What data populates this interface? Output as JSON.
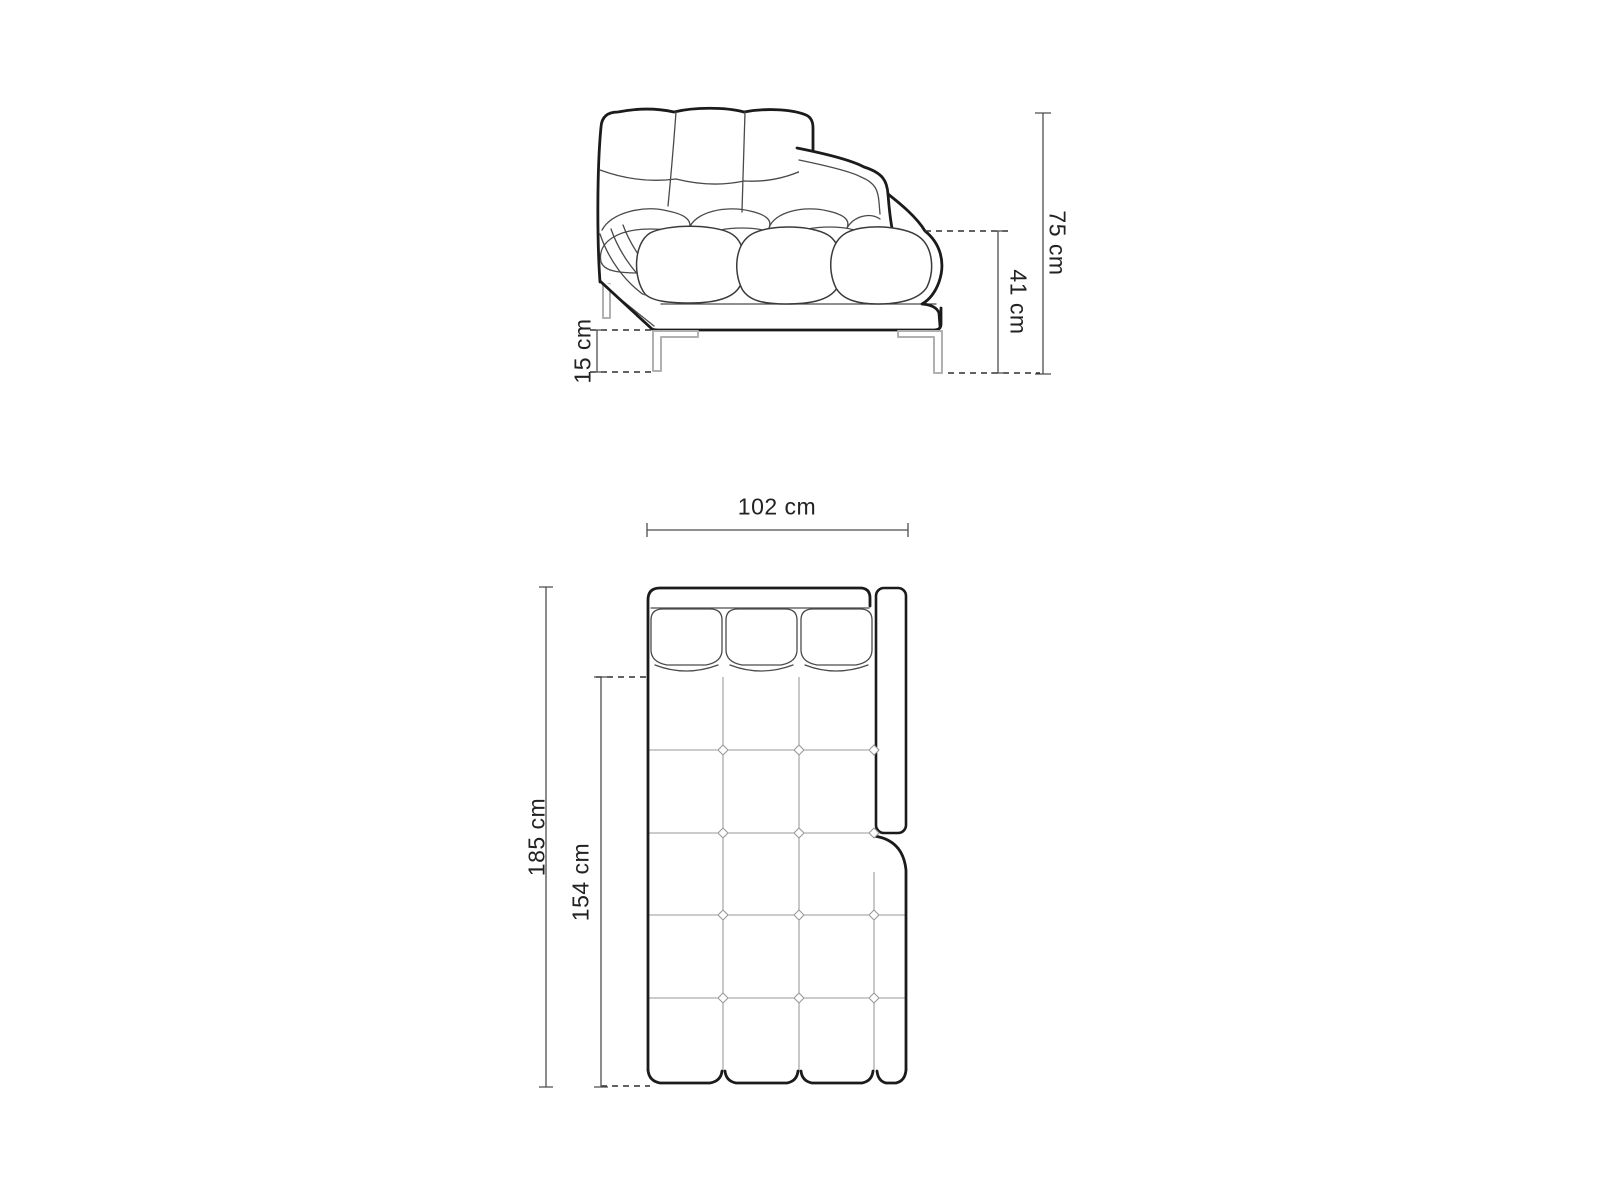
{
  "drawing": {
    "background": "#ffffff",
    "ink_color": "#1b1b1b",
    "detail_line_color": "#4a4a4a",
    "grid_line_color": "#9a9a9a",
    "leg_line_color": "#b0b0b0",
    "dimension_line_color": "#4d4d4d",
    "label_color": "#222222"
  },
  "side_view": {
    "dimensions": {
      "total_height": {
        "label": "75 cm",
        "value": 75,
        "unit": "cm"
      },
      "seat_height": {
        "label": "41 cm",
        "value": 41,
        "unit": "cm"
      },
      "leg_height": {
        "label": "15 cm",
        "value": 15,
        "unit": "cm"
      }
    }
  },
  "plan_view": {
    "dimensions": {
      "width": {
        "label": "102 cm",
        "value": 102,
        "unit": "cm"
      },
      "total_depth": {
        "label": "185 cm",
        "value": 185,
        "unit": "cm"
      },
      "seat_depth": {
        "label": "154 cm",
        "value": 154,
        "unit": "cm"
      }
    }
  }
}
